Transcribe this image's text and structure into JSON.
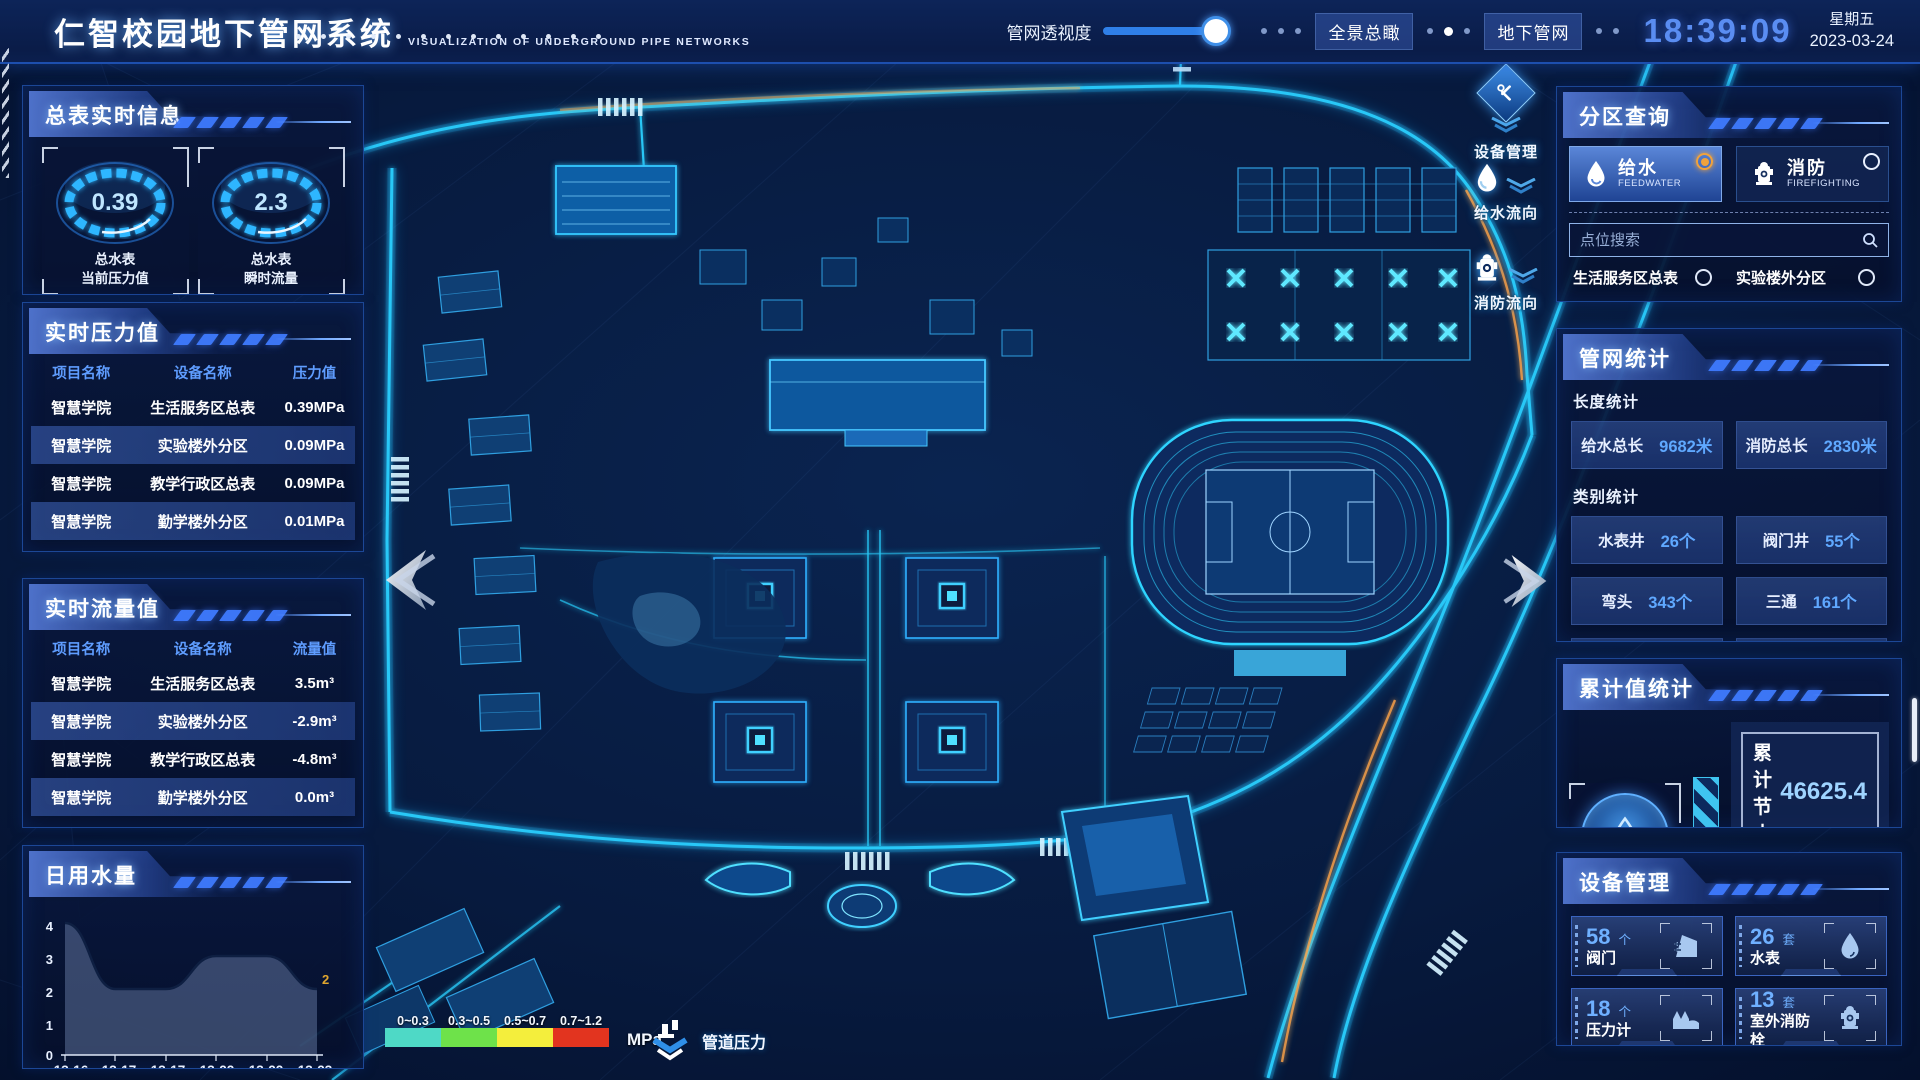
{
  "header": {
    "title": "仁智校园地下管网系统",
    "subtitle": "VISUALIZATION OF UNDERGROUND PIPE NETWORKS",
    "transparency_label": "管网透视度",
    "transparency_percent": 88,
    "buttons": [
      {
        "label": "全景总瞰"
      },
      {
        "label": "地下管网"
      }
    ],
    "clock": {
      "time": "18:39:09",
      "weekday": "星期五",
      "date": "2023-03-24"
    }
  },
  "left": {
    "realtime_info": {
      "title": "总表实时信息",
      "gauges": [
        {
          "value": "0.39",
          "label_line1": "总水表",
          "label_line2": "当前压力值"
        },
        {
          "value": "2.3",
          "label_line1": "总水表",
          "label_line2": "瞬时流量"
        }
      ]
    },
    "pressure": {
      "title": "实时压力值",
      "columns": [
        "项目名称",
        "设备名称",
        "压力值"
      ],
      "rows": [
        [
          "智慧学院",
          "生活服务区总表",
          "0.39MPa"
        ],
        [
          "智慧学院",
          "实验楼外分区",
          "0.09MPa"
        ],
        [
          "智慧学院",
          "教学行政区总表",
          "0.09MPa"
        ],
        [
          "智慧学院",
          "勤学楼外分区",
          "0.01MPa"
        ],
        [
          "智慧学院",
          "砺学楼外分区",
          "0.00MPa"
        ]
      ]
    },
    "flow": {
      "title": "实时流量值",
      "columns": [
        "项目名称",
        "设备名称",
        "流量值"
      ],
      "rows": [
        [
          "智慧学院",
          "生活服务区总表",
          "3.5m³"
        ],
        [
          "智慧学院",
          "实验楼外分区",
          "-2.9m³"
        ],
        [
          "智慧学院",
          "教学行政区总表",
          "-4.8m³"
        ],
        [
          "智慧学院",
          "勤学楼外分区",
          "0.0m³"
        ],
        [
          "智慧学院",
          "砺学楼外分区",
          "2.2m³"
        ]
      ]
    },
    "daily_water": {
      "title": "日用水量"
    }
  },
  "chart_data": {
    "type": "area",
    "title": "日用水量",
    "x": [
      "13:16",
      "13:17",
      "13:17",
      "13:22",
      "13:22",
      "13:23"
    ],
    "values": [
      4,
      2,
      2,
      3,
      3,
      2
    ],
    "ylim": [
      0,
      4
    ],
    "yticks": [
      "4",
      "3",
      "2",
      "1",
      "0"
    ],
    "end_label": "2",
    "end_label_color": "#e0a62e",
    "area_color": "#5f739b",
    "legend_position": "none",
    "grid": false
  },
  "right": {
    "zone_query": {
      "title": "分区查询",
      "tabs": [
        {
          "label": "给水",
          "sub": "FEEDWATER",
          "selected": true
        },
        {
          "label": "消防",
          "sub": "FIREFIGHTING",
          "selected": false
        }
      ],
      "search_placeholder": "点位搜索",
      "items": [
        "生活服务区总表",
        "实验楼外分区",
        "教学行政区总表",
        "勤学楼外分区",
        "砺学楼外分区",
        "宿舍区泵房"
      ]
    },
    "pipe_stats": {
      "title": "管网统计",
      "length_label": "长度统计",
      "length_stats": [
        {
          "label": "给水总长",
          "value": "9682米"
        },
        {
          "label": "消防总长",
          "value": "2830米"
        }
      ],
      "category_label": "类别统计",
      "category_stats": [
        {
          "label": "水表井",
          "value": "26个"
        },
        {
          "label": "阀门井",
          "value": "55个"
        },
        {
          "label": "弯头",
          "value": "343个"
        },
        {
          "label": "三通",
          "value": "161个"
        }
      ]
    },
    "cumulative": {
      "title": "累计值统计",
      "rows": [
        {
          "label": "累计节水",
          "value": "46625.4"
        },
        {
          "label": "累计流量",
          "value": "42104"
        }
      ]
    },
    "devices": {
      "title": "设备管理",
      "cards": [
        {
          "count": "58",
          "unit": "个",
          "label": "阀门",
          "icon": "valve-icon"
        },
        {
          "count": "26",
          "unit": "套",
          "label": "水表",
          "icon": "water-meter-icon"
        },
        {
          "count": "18",
          "unit": "个",
          "label": "压力计",
          "icon": "pressure-gauge-icon"
        },
        {
          "count": "13",
          "unit": "套",
          "label": "室外消防栓",
          "icon": "hydrant-icon"
        }
      ]
    }
  },
  "map": {
    "float_buttons": [
      {
        "label": "设备管理",
        "icon": "tools-icon"
      },
      {
        "label": "给水流向",
        "icon": "water-drop-icon"
      },
      {
        "label": "消防流向",
        "icon": "hydrant-icon"
      }
    ],
    "legend": {
      "bands": [
        {
          "range": "0~0.3",
          "color": "#4ed9c6"
        },
        {
          "range": "0.3~0.5",
          "color": "#6ee24a"
        },
        {
          "range": "0.5~0.7",
          "color": "#f4ee3c"
        },
        {
          "range": "0.7~1.2",
          "color": "#e2341f"
        }
      ],
      "unit": "MPa",
      "pressure_label": "管道压力"
    }
  }
}
